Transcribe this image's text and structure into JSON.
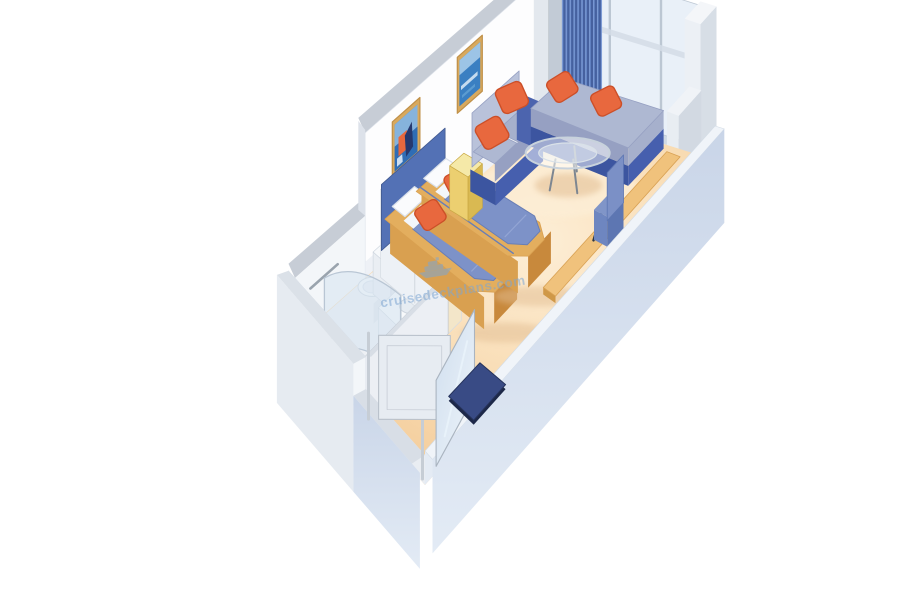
{
  "watermark": {
    "text": "cruisedeckplans.com",
    "icon": "cruise-ship-icon"
  },
  "colors": {
    "carpet_light": "#fdeed6",
    "carpet_mid": "#f8dab0",
    "carpet_dark": "#f1c691",
    "wall_white": "#fdfdfe",
    "wall_trim": "#c7cdd6",
    "wall_shadow": "#dde2ea",
    "wall_base": "#eef1f6",
    "glass": "#e9f0f8",
    "glass_sill": "#cfd9e4",
    "mullion": "#bcc7d3",
    "rail": "#d3dce6",
    "warm_wall": "#f5e3b0",
    "curtain": "#5d80c4",
    "curtain_dark": "#46619f",
    "curtain_light": "#7e9bd4",
    "col_top": "#eef1f5",
    "col_front": "#e3e8ee",
    "col_side": "#c2cbd6",
    "pillar_top": "#f4f6f9",
    "pillar_front": "#ecf0f5",
    "pillar_side": "#d7dee6",
    "slab_top": "#f0f3f7",
    "slab_front": "#e8edf2",
    "slab_side": "#d2d9e2",
    "headboard": "#5371b5",
    "headboard_edge": "#41598f",
    "bed_blue": "#7d92c8",
    "bed_blue_edge": "#687eb6",
    "bed_fold": "#93a5d4",
    "sheet": "#f3f6fa",
    "pillow": "#fafbfd",
    "pillow_shade": "#d9e0ea",
    "tan": "#e3ae5e",
    "tan_front": "#d9a050",
    "tan_side": "#c8893c",
    "orange": "#e8683e",
    "orange_dark": "#cc4f28",
    "sofa_base": "#3c55a0",
    "sofa_base_side": "#465fae",
    "sofa_arm": "#4c64ae",
    "seat": "#aeb8d2",
    "seat2": "#a6b0cc",
    "seat_front": "#96a0c2",
    "sofa_back": "#b9c2da",
    "stool_top": "#f5e9a8",
    "stool_front": "#eccf70",
    "stool_side": "#d9b952",
    "stool_edge": "#c9a843",
    "desk_top": "#f0c27c",
    "desk_edge": "#d9a255",
    "desk_cap": "#cf9848",
    "chair_top": "#8095c8",
    "chair_front": "#6e86c0",
    "chair_side": "#5d76b2",
    "chair_back": "#7b90c6",
    "chair_leg": "#2e3744",
    "table_rim": "#c8d2dc",
    "table_rim2": "#d9e1e8",
    "table_leg": "#7d8691",
    "floor_shadow": "#e2bd92",
    "rw_inner": "#e4ebf4",
    "rw_top": "#f0f4f9",
    "rw_outer1": "#c9d5e8",
    "rw_outer2": "#e3ebf5",
    "bath_floor": "#edf0f4",
    "fixture": "#f7f9fb",
    "fixture_shade": "#dfe5eb",
    "fixture_mid": "#eaeef3",
    "basin": "#e6ecf2",
    "basin_rim": "#cdd5de",
    "metal": "#9aa4ae",
    "shower_glass": "rgba(214,228,240,0.55)",
    "shower_edge": "#b9c6d4",
    "closet_face": "#edf1f6",
    "closet_side": "#f3e6c9",
    "closet_top": "#f7f9fb",
    "closet_seam": "#d6dce3",
    "handle": "#6b7684",
    "cw_face": "#eceff4",
    "cw_top": "#d8dee6",
    "door": "#e7ecf2",
    "door_edge": "#b9c1cb",
    "frame": "#c6cdd5",
    "mirror1": "#cfdeee",
    "mirror2": "#eef4fa",
    "mirror_edge": "#aab4c0",
    "ew_inner": "#f3f6f9",
    "ew_top": "#dbe1e8",
    "ew_outer": "#e6ebf1",
    "ew_low": "#e9edf2",
    "ew_low_top": "#d8dee6",
    "mat": "#26335c",
    "mat_top": "#394b85",
    "mat_edge": "#1d2848",
    "pic_frame": "#d8a95e",
    "pic_frame_edge": "#c09048",
    "art_blue": "#2f6db5",
    "art_blue2": "#3a7fc2",
    "art_sky": "#9cc4e6",
    "art_light": "#5b9bd0",
    "art_navy": "#26386e",
    "art_white": "#e8f2fa",
    "watermark_blue": "#7ea6d2"
  }
}
